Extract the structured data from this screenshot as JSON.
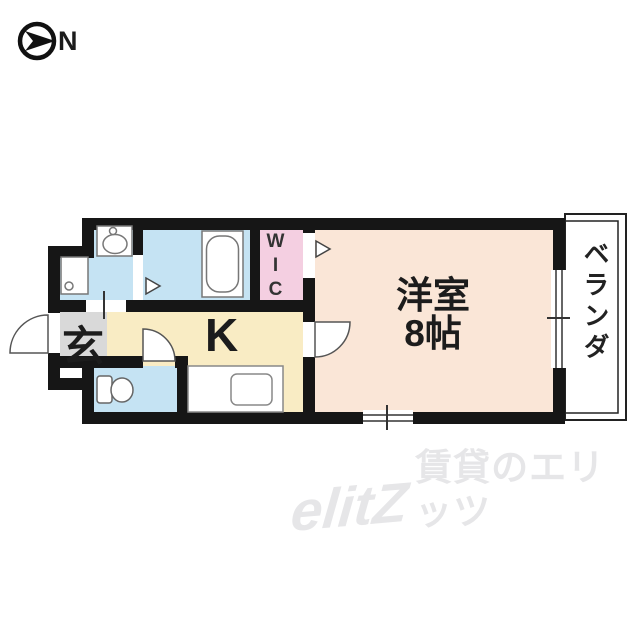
{
  "compass": {
    "direction_label": "N"
  },
  "floor_plan": {
    "rooms": [
      {
        "id": "entrance",
        "label": "玄",
        "color": "#d9d9d9"
      },
      {
        "id": "kitchen",
        "label": "K",
        "color": "#f9ecc4"
      },
      {
        "id": "wic",
        "label": "WIC",
        "color": "#f4cfe1"
      },
      {
        "id": "western_room",
        "label": "洋室",
        "size_label": "8帖",
        "color": "#fae6d7"
      },
      {
        "id": "veranda",
        "label": "ベランダ",
        "color": "#ffffff"
      },
      {
        "id": "washroom",
        "color": "#c5e3f3"
      },
      {
        "id": "bathroom",
        "color": "#c5e3f3"
      },
      {
        "id": "toilet_room",
        "color": "#c5e3f3"
      }
    ],
    "wall_color": "#161616",
    "fixture_outline_color": "#777777"
  },
  "watermark": {
    "logo": "elitZ",
    "text": "賃貸のエリッツ",
    "color": "#e6e6e8"
  }
}
